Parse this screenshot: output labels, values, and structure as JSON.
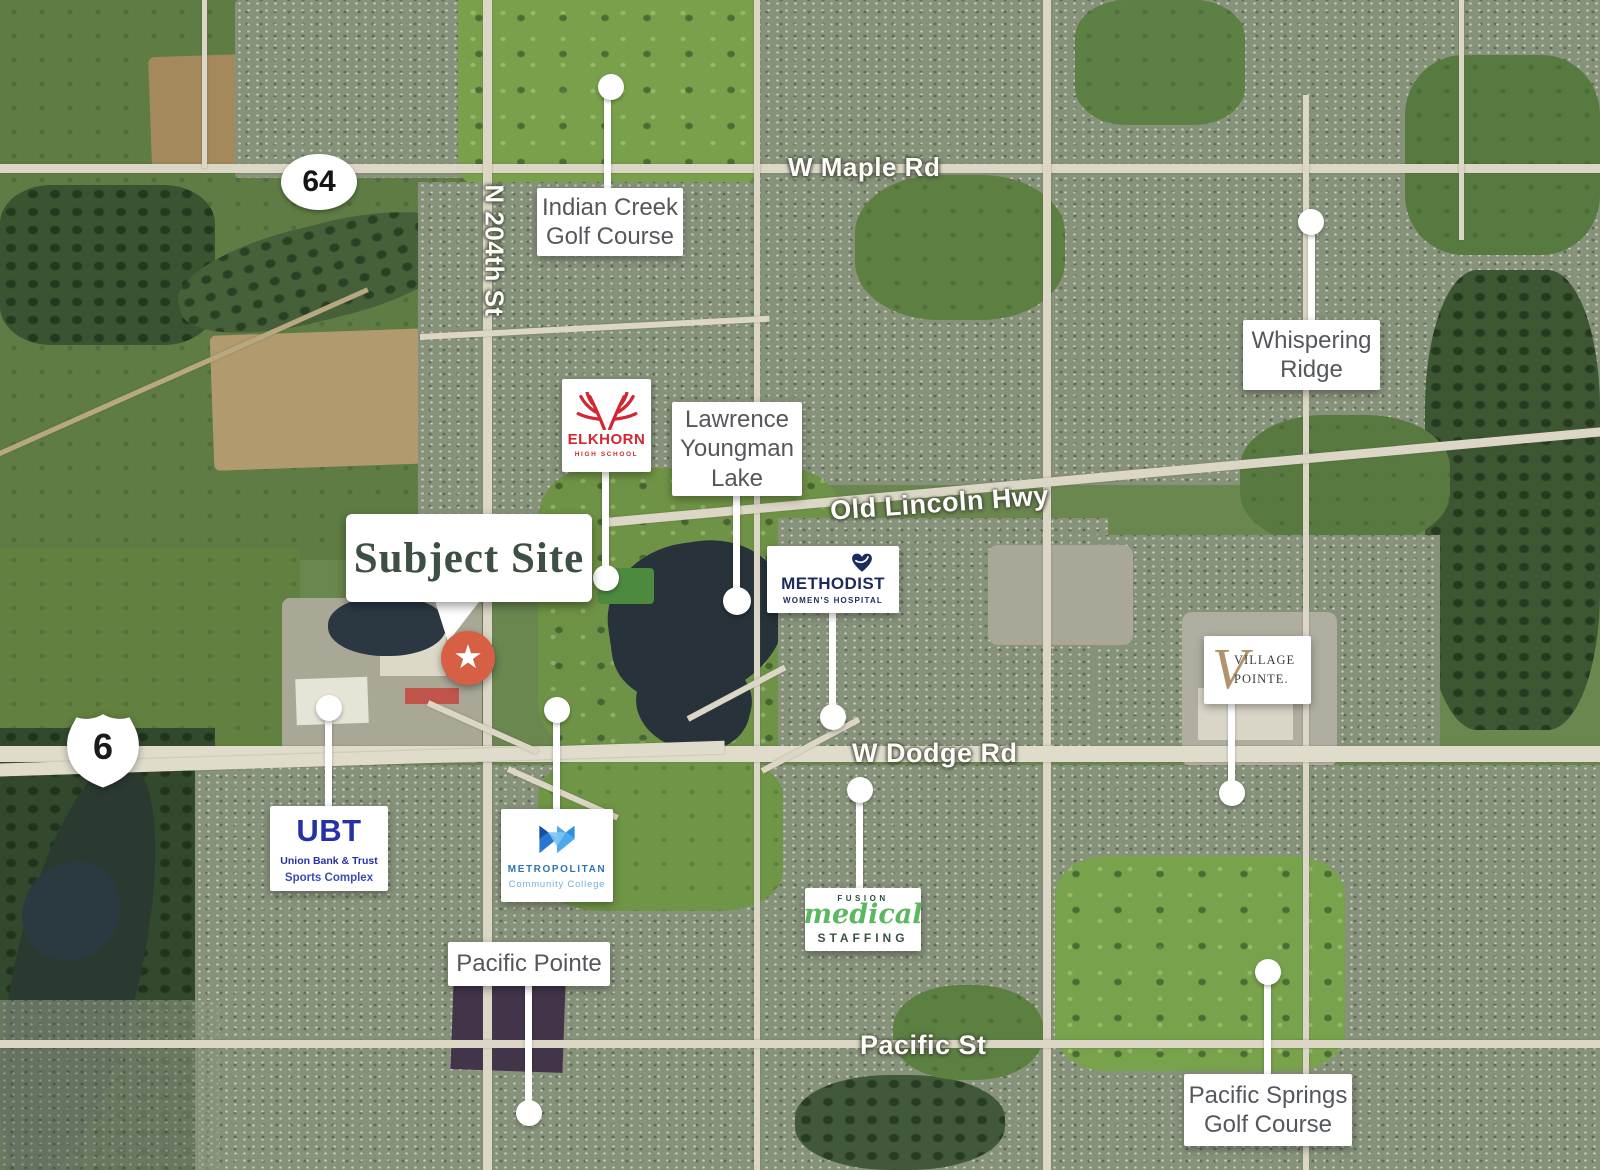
{
  "shields": {
    "route64": "64",
    "route6": "6"
  },
  "road_labels": {
    "w_maple_rd": "W Maple Rd",
    "n_204th_st": "N 204th St",
    "old_lincoln_hwy": "Old Lincoln Hwy",
    "w_dodge_rd": "W Dodge Rd",
    "pacific_st": "Pacific St"
  },
  "subject_site": {
    "label": "Subject Site",
    "marker_icon": "★",
    "marker_color": "#d75f44"
  },
  "callouts": {
    "indian_creek": {
      "line1": "Indian Creek",
      "line2": "Golf Course"
    },
    "whispering_ridge": {
      "line1": "Whispering",
      "line2": "Ridge"
    },
    "lawrence_youngman_lake": {
      "line1": "Lawrence",
      "line2": "Youngman",
      "line3": "Lake"
    },
    "pacific_pointe": {
      "line1": "Pacific Pointe"
    },
    "pacific_springs": {
      "line1": "Pacific Springs",
      "line2": "Golf Course"
    }
  },
  "logos": {
    "elkhorn": {
      "name": "ELKHORN",
      "subtitle": "HIGH SCHOOL",
      "color": "#d22630"
    },
    "methodist": {
      "name": "METHODIST",
      "subtitle": "WOMEN'S HOSPITAL",
      "color": "#1c2b5e"
    },
    "village_pointe": {
      "monogram": "V",
      "line1": "VILLAGE",
      "line2": "POINTE.",
      "accent_color": "#b1946a"
    },
    "ubt": {
      "name": "UBT",
      "line1": "Union Bank & Trust",
      "line2": "Sports Complex",
      "color": "#2531a5"
    },
    "metropolitan": {
      "name": "METROPOLITAN",
      "subtitle": "Community College",
      "color": "#2e74b5"
    },
    "fusion_medical": {
      "line1": "FUSION",
      "line2": "medical",
      "line3": "STAFFING",
      "accent_color": "#5cb860"
    }
  }
}
